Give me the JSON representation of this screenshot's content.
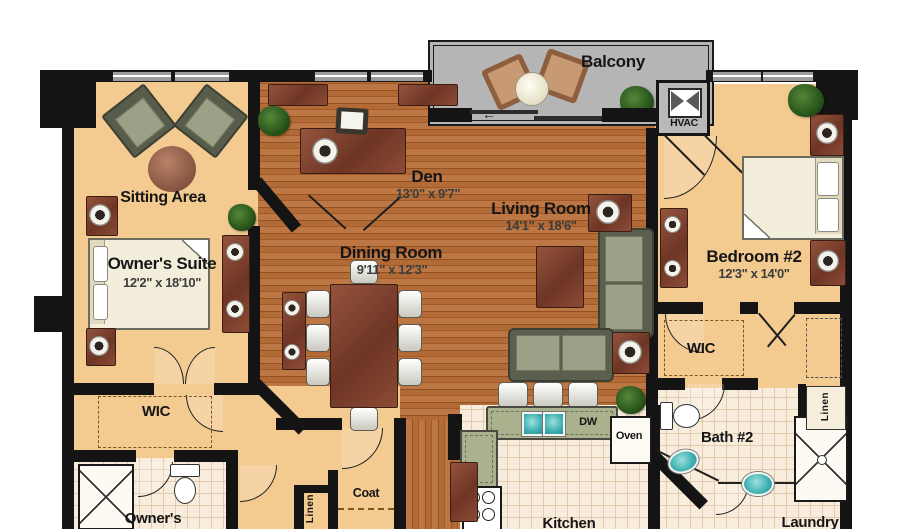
{
  "plan_title": "Condo Unit Floor Plan",
  "colors": {
    "wall": "#141414",
    "tan_floor": "#f3ca90",
    "wood_floor": "#b26a36",
    "tile_floor": "#f8ecdc",
    "balcony_floor": "#b5b5b5",
    "counter": "#a9b28c",
    "sink_teal": "#3eb0b2",
    "furniture_mahogany": "#7e4233",
    "sofa_green": "#9ba186",
    "label_text": "#161616"
  },
  "balcony": {
    "label": "Balcony"
  },
  "hvac": {
    "label": "HVAC"
  },
  "rooms": {
    "sitting_area": {
      "name": "Sitting Area"
    },
    "owners_suite": {
      "name": "Owner's Suite",
      "dims": "12'2\" x 18'10\""
    },
    "den": {
      "name": "Den",
      "dims": "13'0\" x 9'7\""
    },
    "dining_room": {
      "name": "Dining Room",
      "dims": "9'11\" x 12'3\""
    },
    "living_room": {
      "name": "Living Room",
      "dims": "14'1\" x 18'6\""
    },
    "bedroom_2": {
      "name": "Bedroom #2",
      "dims": "12'3\" x 14'0\""
    },
    "wic_left": {
      "name": "WIC"
    },
    "wic_right": {
      "name": "WIC"
    },
    "bath_2": {
      "name": "Bath #2"
    },
    "owners_bath": {
      "name": "Owner's"
    },
    "kitchen": {
      "name": "Kitchen"
    },
    "laundry": {
      "name": "Laundry"
    },
    "coat": {
      "name": "Coat"
    },
    "linen_hall": {
      "name": "Linen"
    },
    "linen_bath": {
      "name": "Linen"
    }
  },
  "appliances": {
    "dishwasher": "DW",
    "oven": "Oven"
  }
}
